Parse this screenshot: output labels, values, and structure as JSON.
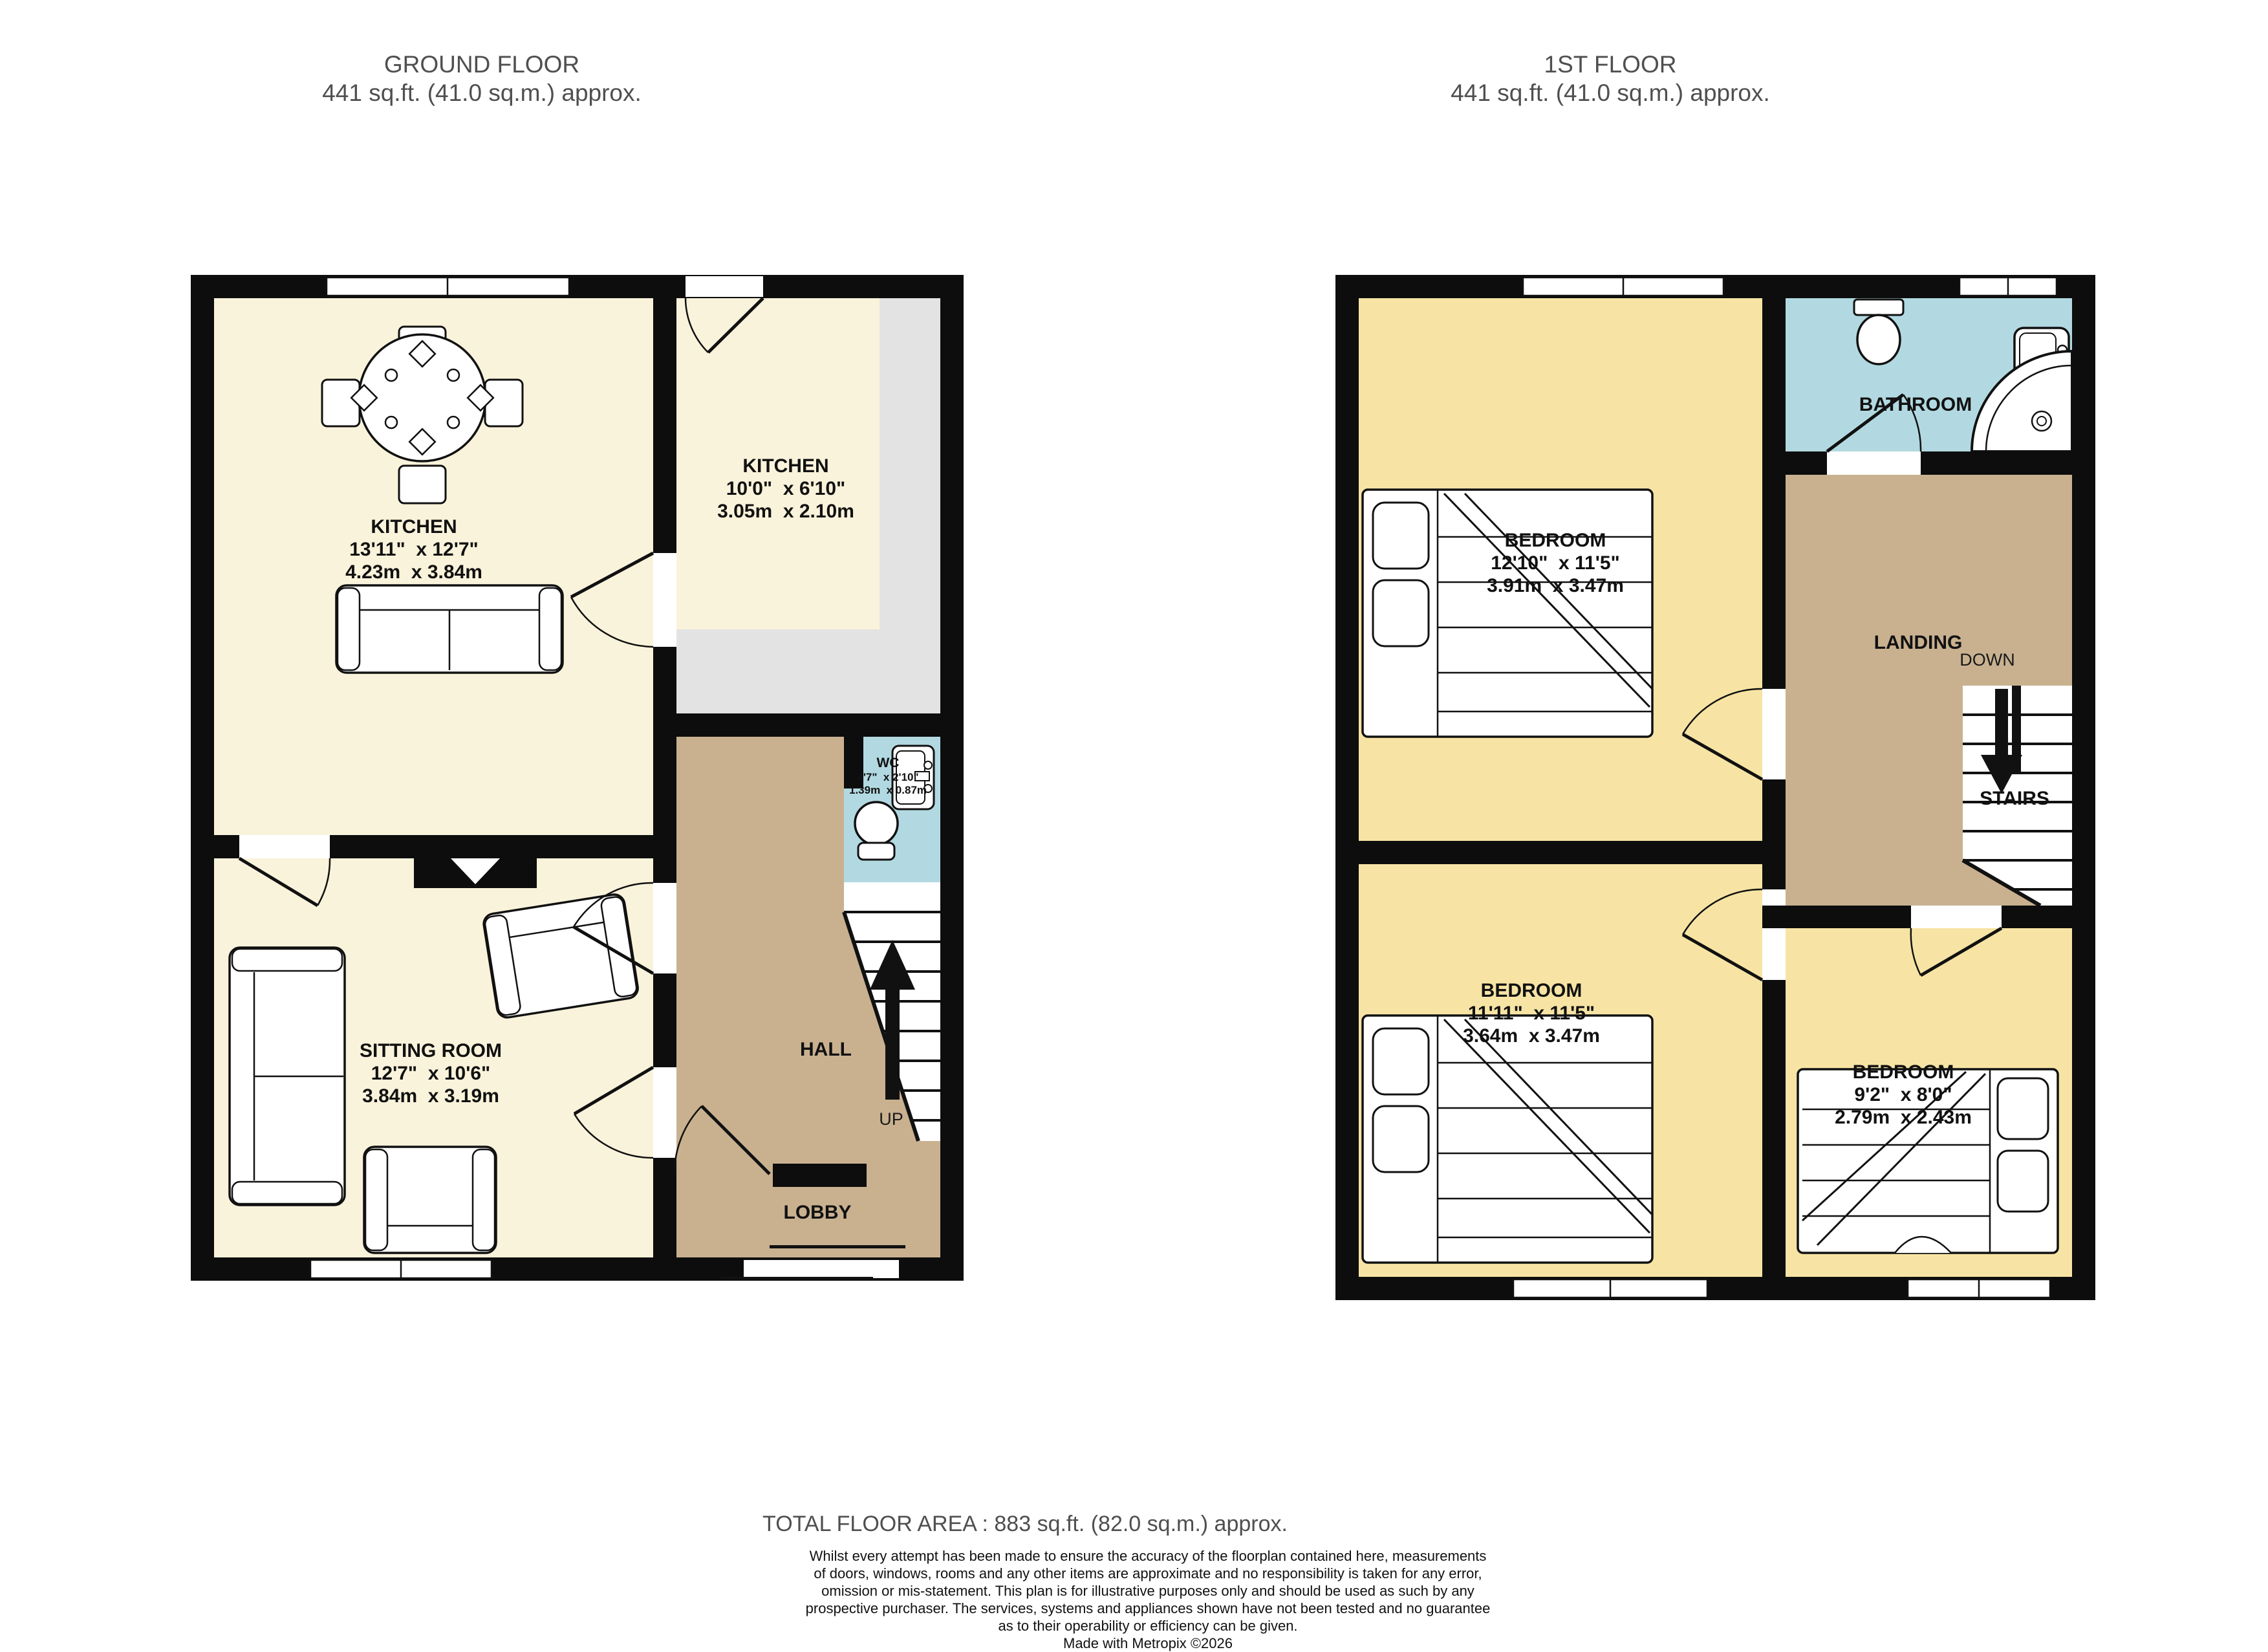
{
  "ground_floor": {
    "title": "GROUND FLOOR",
    "subtitle": "441 sq.ft. (41.0 sq.m.) approx.",
    "rooms": {
      "kitchen_main": {
        "name": "KITCHEN",
        "imperial": "13'11\"  x 12'7\"",
        "metric": "4.23m  x 3.84m"
      },
      "kitchen_small": {
        "name": "KITCHEN",
        "imperial": "10'0\"  x 6'10\"",
        "metric": "3.05m  x 2.10m"
      },
      "sitting_room": {
        "name": "SITTING ROOM",
        "imperial": "12'7\"  x 10'6\"",
        "metric": "3.84m  x 3.19m"
      },
      "wc": {
        "name": "WC",
        "imperial": "4'7\"  x 2'10\"",
        "metric": "1.39m  x 0.87m"
      },
      "hall": {
        "name": "HALL"
      },
      "lobby": {
        "name": "LOBBY"
      }
    },
    "stairs_direction": "UP"
  },
  "first_floor": {
    "title": "1ST FLOOR",
    "subtitle": "441 sq.ft. (41.0 sq.m.) approx.",
    "rooms": {
      "bedroom_1": {
        "name": "BEDROOM",
        "imperial": "12'10\"  x 11'5\"",
        "metric": "3.91m  x 3.47m"
      },
      "bedroom_2": {
        "name": "BEDROOM",
        "imperial": "11'11\"  x 11'5\"",
        "metric": "3.64m  x 3.47m"
      },
      "bedroom_3": {
        "name": "BEDROOM",
        "imperial": "9'2\"  x 8'0\"",
        "metric": "2.79m  x 2.43m"
      },
      "bathroom": {
        "name": "BATHROOM"
      },
      "landing": {
        "name": "LANDING"
      },
      "stairs": {
        "name": "STAIRS"
      }
    },
    "stairs_direction": "DOWN"
  },
  "footer": {
    "total_area": "TOTAL FLOOR AREA : 883 sq.ft. (82.0 sq.m.) approx.",
    "disclaimer_lines": [
      "Whilst every attempt has been made to ensure the accuracy of the floorplan contained here, measurements",
      "of doors, windows, rooms and any other items are approximate and no responsibility is taken for any error,",
      "omission or mis-statement. This plan is for illustrative purposes only and should be used as such by any",
      "prospective purchaser. The services, systems and appliances shown have not been tested and no guarantee",
      "as to their operability or efficiency can be given."
    ],
    "credit": "Made with Metropix ©2026"
  },
  "colors": {
    "wall": "#0d0d0d",
    "room_cream": "#FAF3DB",
    "room_yellow": "#F7E4A4",
    "hall_tan": "#C9B190",
    "wet_room_blue": "#B2D9E1",
    "counter_grey": "#E3E3E3",
    "title_grey": "#4F4F4F"
  }
}
